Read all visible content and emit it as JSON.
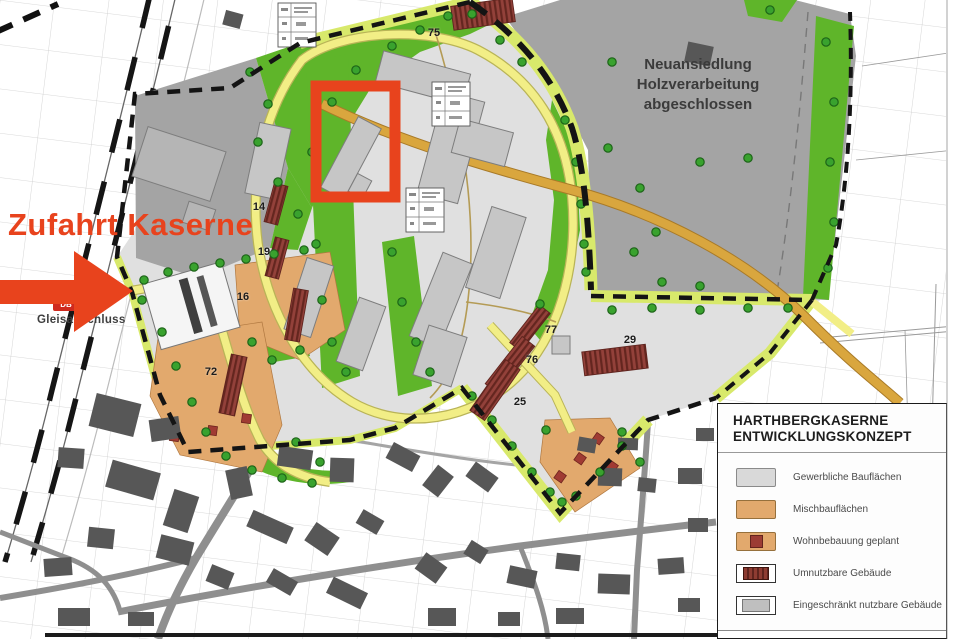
{
  "annotations": {
    "zufahrt_kaserne": "Zufahrt Kaserne",
    "gleisanschluss": "Gleisanschluss",
    "db_logo": "DB",
    "neuansiedlung_line1": "Neuansiedlung",
    "neuansiedlung_line2": "Holzverarbeitung",
    "neuansiedlung_line3": "abgeschlossen"
  },
  "map": {
    "building_numbers": {
      "n75": "75",
      "n14": "14",
      "n19": "19",
      "n16": "16",
      "n72": "72",
      "n77": "77",
      "n76": "76",
      "n29": "29",
      "n25": "25"
    }
  },
  "legend": {
    "title_line1": "HARTHBERGKASERNE",
    "title_line2": "ENTWICKLUNGSKONZEPT",
    "items": [
      {
        "label": "Gewerbliche Bauflächen",
        "swatch": "commercial-gray"
      },
      {
        "label": "Mischbauflächen",
        "swatch": "mixed-orange"
      },
      {
        "label": "Wohnbebauung geplant",
        "swatch": "orange-with-red-square"
      },
      {
        "label": "Umnutzbare Gebäude",
        "swatch": "darkred-hatched-building"
      },
      {
        "label": "Eingeschränkt nutzbare Gebäude",
        "swatch": "gray-building"
      }
    ],
    "footer": "PLANUNGSGRUPPE  IKOS"
  },
  "colors": {
    "annotation_red": "#e8431d",
    "commercial_gray": "#d9d9d9",
    "mixed_orange": "#e2a96d",
    "reusable_darkred": "#8e3c32",
    "green_space": "#5fb52a",
    "road_yellow": "#f2ee86",
    "main_road_tan": "#d9a63e",
    "boundary_black": "#141414"
  }
}
